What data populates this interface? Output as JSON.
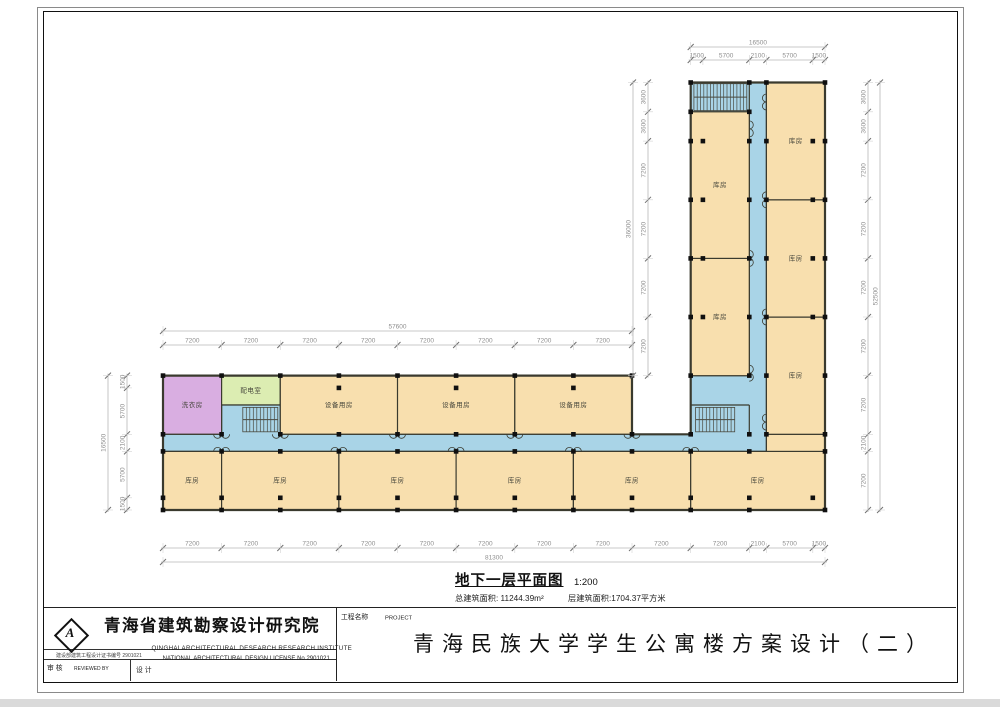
{
  "plan": {
    "caption": {
      "title": "地下一层平面图",
      "scale": "1:200",
      "area_total": "总建筑面积: 11244.39m²",
      "area_floor": "层建筑面积:1704.37平方米"
    },
    "colors": {
      "room": "#f8dfae",
      "corridor": "#a9d4e7",
      "laundry": "#d9aee1",
      "power": "#dcedb2",
      "wall": "#3a3a2e",
      "column": "#101010",
      "dim_line": "#b8b8b8",
      "dim_tick": "#6f6f6f",
      "dim_text": "#8f8f8f",
      "ext_line": "#d2d2d2",
      "label": "#44443a",
      "stair": "#4a4a40"
    },
    "outline": [
      [
        0,
        0
      ],
      [
        0,
        16500
      ],
      [
        57600,
        16500
      ],
      [
        57600,
        9300
      ],
      [
        64800,
        9300
      ],
      [
        64800,
        52500
      ],
      [
        81300,
        52500
      ],
      [
        81300,
        0
      ]
    ],
    "corridor_outline": [
      [
        0,
        7200
      ],
      [
        74100,
        7200
      ],
      [
        74100,
        52500
      ],
      [
        64800,
        52500
      ],
      [
        64800,
        48900
      ],
      [
        72000,
        48900
      ],
      [
        72000,
        16500
      ],
      [
        64800,
        16500
      ],
      [
        64800,
        9300
      ],
      [
        14400,
        9300
      ],
      [
        14400,
        12900
      ],
      [
        7200,
        12900
      ],
      [
        7200,
        9300
      ],
      [
        0,
        9300
      ]
    ],
    "rooms": [
      {
        "label": "洗衣房",
        "x": 0,
        "y": 9300,
        "w": 7200,
        "h": 7200,
        "fill": "laundry"
      },
      {
        "label": "配电室",
        "x": 7200,
        "y": 12900,
        "w": 7200,
        "h": 3600,
        "fill": "power"
      },
      {
        "label": "设备用房",
        "x": 14400,
        "y": 9300,
        "w": 14400,
        "h": 7200
      },
      {
        "label": "设备用房",
        "x": 28800,
        "y": 9300,
        "w": 14400,
        "h": 7200
      },
      {
        "label": "设备用房",
        "x": 43200,
        "y": 9300,
        "w": 14400,
        "h": 7200
      },
      {
        "label": "库房",
        "x": 0,
        "y": 0,
        "w": 7200,
        "h": 7200
      },
      {
        "label": "库房",
        "x": 7200,
        "y": 0,
        "w": 14400,
        "h": 7200
      },
      {
        "label": "库房",
        "x": 21600,
        "y": 0,
        "w": 14400,
        "h": 7200
      },
      {
        "label": "库房",
        "x": 36000,
        "y": 0,
        "w": 14400,
        "h": 7200
      },
      {
        "label": "库房",
        "x": 50400,
        "y": 0,
        "w": 14400,
        "h": 7200
      },
      {
        "label": "库房",
        "x": 64800,
        "y": 0,
        "w": 16500,
        "h": 7200
      },
      {
        "label": "",
        "x": 74100,
        "y": 7200,
        "w": 7200,
        "h": 2100
      },
      {
        "label": "库房",
        "x": 64800,
        "y": 16500,
        "w": 7200,
        "h": 14400
      },
      {
        "label": "库房",
        "x": 64800,
        "y": 30900,
        "w": 7200,
        "h": 18000
      },
      {
        "label": "库房",
        "x": 74100,
        "y": 9300,
        "w": 7200,
        "h": 14400
      },
      {
        "label": "库房",
        "x": 74100,
        "y": 23700,
        "w": 7200,
        "h": 14400
      },
      {
        "label": "库房",
        "x": 74100,
        "y": 38100,
        "w": 7200,
        "h": 14400
      }
    ],
    "walls": [
      [
        72000,
        48900,
        72000,
        52500
      ],
      [
        64800,
        12900,
        72000,
        12900
      ],
      [
        72000,
        9300,
        72000,
        12900
      ]
    ],
    "stairs": [
      {
        "x": 65200,
        "y": 49050,
        "w": 6500,
        "h": 3300
      },
      {
        "x": 65400,
        "y": 9600,
        "w": 4800,
        "h": 3000
      },
      {
        "x": 9800,
        "y": 9600,
        "w": 4300,
        "h": 3000
      }
    ],
    "doors": {
      "horizontal": [
        {
          "y": 7200,
          "dir": "up",
          "xs": [
            7200,
            21600,
            36000,
            50400,
            64800
          ]
        },
        {
          "y": 9300,
          "dir": "down",
          "xs": [
            7200,
            14400,
            28800,
            43200,
            57600
          ]
        }
      ],
      "vertical": [
        {
          "x": 72000,
          "dir": "right",
          "ys": [
            16800,
            30900,
            46800
          ]
        },
        {
          "x": 74100,
          "dir": "left",
          "ys": [
            10800,
            23700,
            38100,
            50100
          ]
        }
      ]
    },
    "dim_chains": [
      {
        "id": "vwing-top-total",
        "o": "h",
        "pos": 47,
        "start": 64800,
        "segs": [
          16500
        ]
      },
      {
        "id": "vwing-top",
        "o": "h",
        "pos": 60,
        "start": 64800,
        "segs": [
          1500,
          5700,
          2100,
          5700,
          1500
        ]
      },
      {
        "id": "hwing-top-total",
        "o": "h",
        "pos": 331,
        "start": 0,
        "segs": [
          57600
        ]
      },
      {
        "id": "hwing-top",
        "o": "h",
        "pos": 345,
        "start": 0,
        "segs": [
          7200,
          7200,
          7200,
          7200,
          7200,
          7200,
          7200,
          7200
        ]
      },
      {
        "id": "bottom",
        "o": "h",
        "pos": 548,
        "start": 0,
        "segs": [
          7200,
          7200,
          7200,
          7200,
          7200,
          7200,
          7200,
          7200,
          7200,
          7200,
          2100,
          5700,
          1500
        ]
      },
      {
        "id": "bottom-total",
        "o": "h",
        "pos": 562,
        "start": 0,
        "segs": [
          81300
        ]
      },
      {
        "id": "left-wing",
        "o": "v",
        "pos": 127,
        "top": 16500,
        "segs": [
          1500,
          5700,
          2100,
          5700,
          1500
        ]
      },
      {
        "id": "left-wing-total",
        "o": "v",
        "pos": 108,
        "top": 16500,
        "segs": [
          16500
        ]
      },
      {
        "id": "vwing-left",
        "o": "v",
        "pos": 648,
        "top": 52500,
        "segs": [
          3600,
          3600,
          7200,
          7200,
          7200,
          7200
        ]
      },
      {
        "id": "vwing-left-total",
        "o": "v",
        "pos": 633,
        "top": 52500,
        "segs": [
          36000
        ]
      },
      {
        "id": "right",
        "o": "v",
        "pos": 868,
        "top": 52500,
        "segs": [
          3600,
          3600,
          7200,
          7200,
          7200,
          7200,
          7200,
          2100,
          7200
        ]
      },
      {
        "id": "right-total",
        "o": "v",
        "pos": 880,
        "top": 52500,
        "segs": [
          52500
        ]
      }
    ]
  },
  "title_block": {
    "institute_cn": "青海省建筑勘察设计研究院",
    "institute_en": "QINGHAI ARCHITECTURAL DESEARCH RESEARCH INSTITUTE",
    "license_cn": "建设部建筑工程设计证书编号 2901021",
    "license_en": "NATIONAL ARCHITECTURAL DESIGN LICENSE No   2901021",
    "reviewed_cn": "审 核",
    "reviewed_en": "REVIEWED BY",
    "designed_cn": "设 计",
    "project_label_cn": "工程名称",
    "project_label_en": "PROJECT",
    "project_title": "青海民族大学学生公寓楼方案设计（二）",
    "logo_letter": "A"
  }
}
